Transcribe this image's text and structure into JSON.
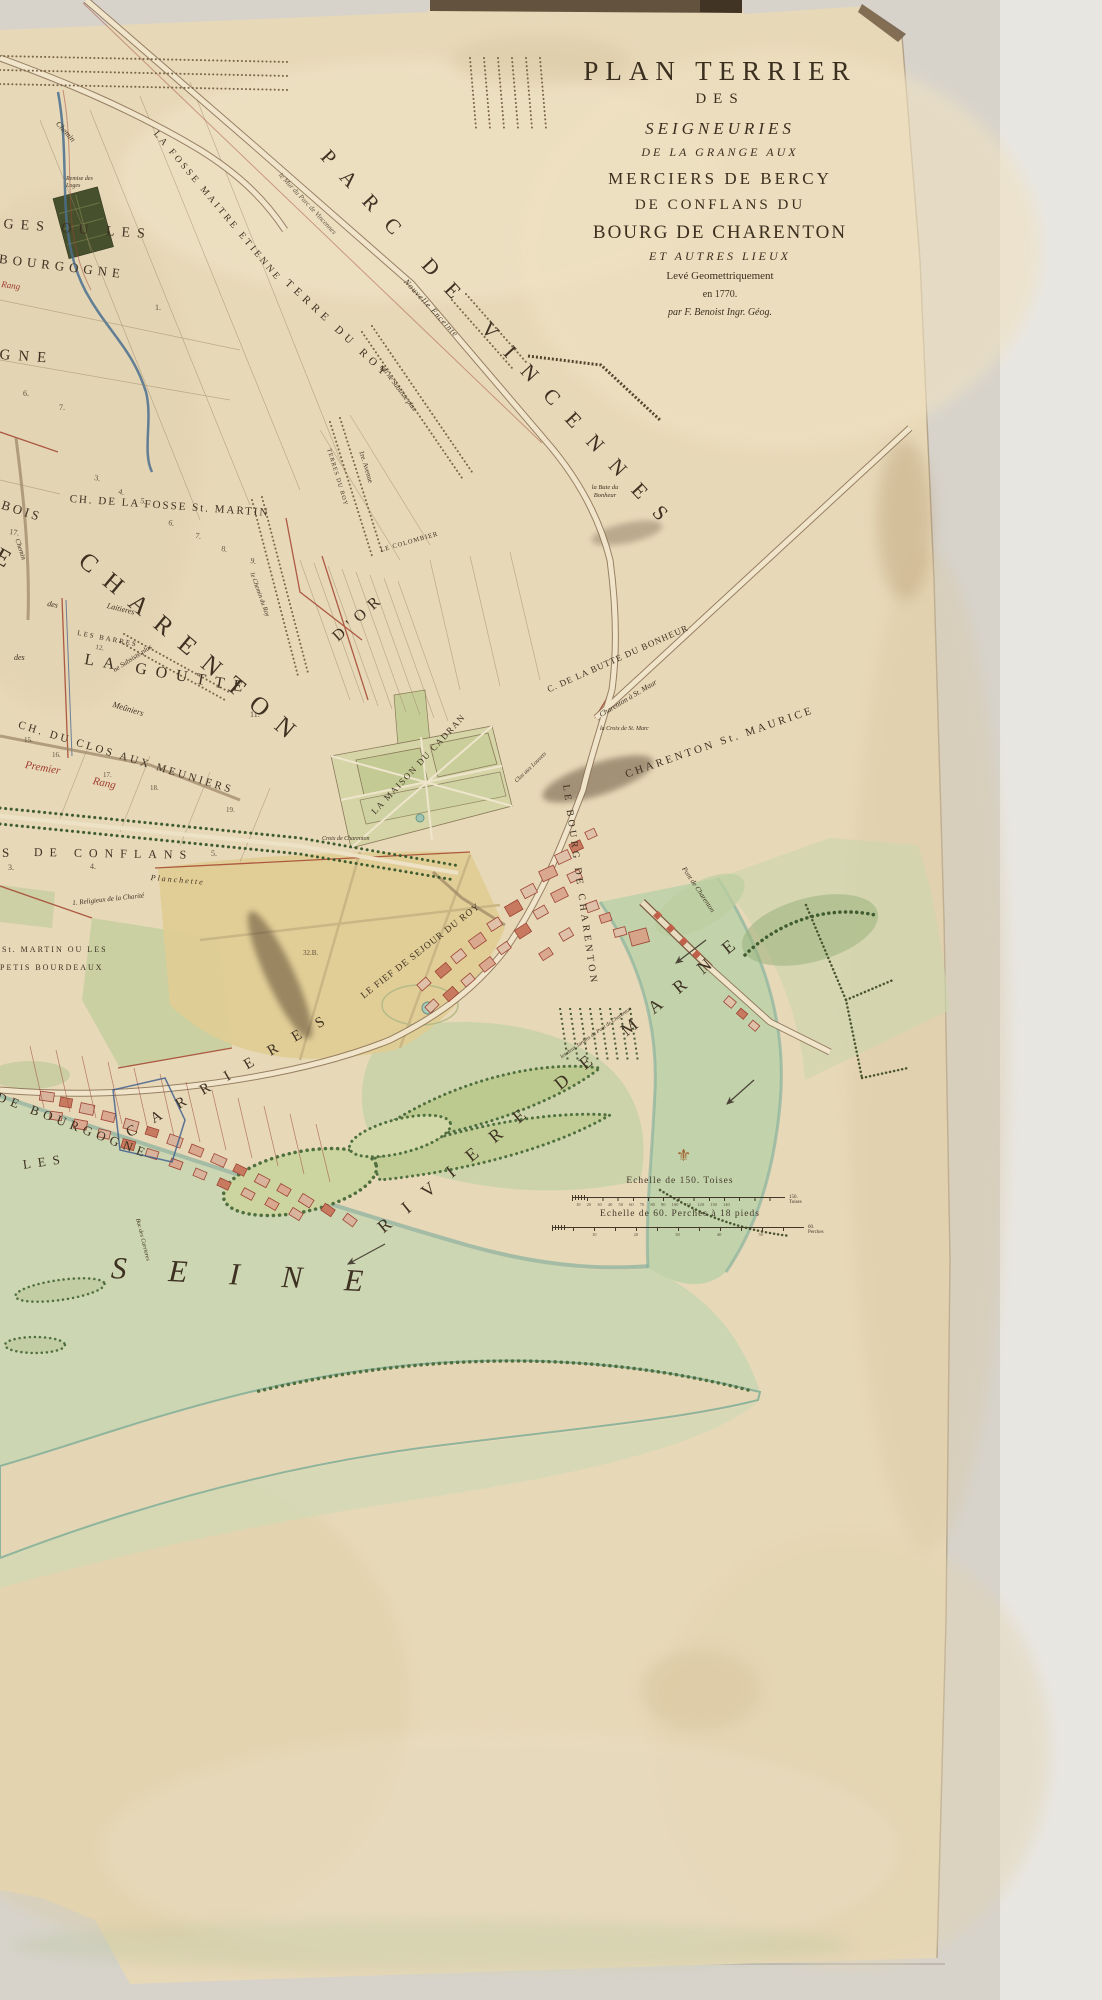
{
  "title": {
    "l1": "PLAN TERRIER",
    "l2": "DES",
    "l3": "SEIGNEURIES",
    "l4": "DE LA GRANGE AUX",
    "l5": "MERCIERS DE BERCY",
    "l6": "DE CONFLANS DU",
    "l7": "BOURG DE CHARENTON",
    "l8": "ET AUTRES LIEUX",
    "l9": "Levé Geomettriquement",
    "l10": "en 1770.",
    "l11": "par F. Benoist Ingr. Géog."
  },
  "labels": {
    "parc_de_vincennes": "PARC DE VINCENNES",
    "mur_parc": "le Mur du Parc de Vincennes",
    "nouvelle_enceinte": "Nouvelle Enceinte",
    "fosse_etienne": "LA FOSSE MAITRE ETIENNE",
    "terre_du_roy": "TERRE DU ROY",
    "terres_du_roy_small": "TERRES DU ROY",
    "chemin": "Chemin",
    "chemin2": "Chemin",
    "remise": "Remise des Loges",
    "ges_ou_les": "GES OU LES",
    "bourgogne": "BOURGOGNE",
    "rang3": "Rang",
    "gne": "GNE",
    "bois": "BOIS",
    "e_letter": "E",
    "ch_fosse_martin": "CH. DE LA FOSSE St. MARTIN",
    "charenton_big": "CHARENTON",
    "la_goutte": "LA GOUTTE",
    "d_or": "D'OR",
    "des1": "des",
    "des2": "des",
    "laitieres": "Laitieres",
    "les_barres": "LES BARRES",
    "ne_subsiste": "ne Subsiste plus",
    "subsiste": "qui ne Subsiste plus",
    "meuniers": "Meûniers",
    "chemin_du_roy": "le Chemin du Roy",
    "avenue": "1re. Avenue",
    "colombier": "LE COLOMBIER",
    "bute_bonheur": "la Bute du Bonheur",
    "ch_clos_meuniers": "CH. DU CLOS AUX MEUNIERS",
    "premier": "Premier",
    "rang": "Rang",
    "s_partial": "S",
    "de_conflans": "DE CONFLANS",
    "planchette": "Planchette",
    "religieux": "1. Religieux de la Charité",
    "st_martin_ou_les": "St. MARTIN OU LES",
    "petis_bourdeaux": "PETIS BOURDEAUX",
    "maison_cadran": "LA MAISON DU CADRAN",
    "croix_charenton": "Croix de Charenton",
    "fief_sejour": "LE FIEF DE SEJOUR DU ROY",
    "bourg_charenton": "LE BOURG DE CHARENTON",
    "butte_bonheur": "C. DE LA BUTTE DU BONHEUR",
    "charenton_st_maur": "Charenton à St. Maur",
    "croix_st_marc": "la Croix de St. Marc",
    "charenton_maurice": "CHARENTON  St. MAURICE",
    "clos_louvets": "Clos aux Louvets",
    "pont_charenton": "Pont de Charenton",
    "jardins_pont": "les deux Jardins du Pont de Charenton",
    "riviere_de_marne": "RIVIERE DE MARNE",
    "de_bourgogne": "DE BOURGOGNE",
    "les": "LES",
    "carrieres": "CARRIERES",
    "bac_carrieres": "Bac des Carrieres",
    "seine": "SEINE"
  },
  "numbers": {
    "f3": "3.",
    "f4": "4.",
    "f5": "5.",
    "f6": "6.",
    "f7": "7.",
    "f8": "8.",
    "f9": "9.",
    "f11": "11.",
    "f12": "12.",
    "f17": "17.",
    "p1": "1.",
    "p6": "6.",
    "p7": "7.",
    "m15": "15.",
    "m16": "16.",
    "m17": "17.",
    "m18": "18.",
    "m19": "19.",
    "c3": "3.",
    "c4": "4.",
    "c5": "5.",
    "b32": "32.B."
  },
  "scale": {
    "toises_title": "Echelle de 150. Toises",
    "toises_ticks": "10 20 30 40 50 60 70 80 90 100 110 120 130 140",
    "toises_end": "150. Toises",
    "perches_title": "Echelle de 60. Perches à 18 pieds",
    "perches_ticks": "10 20 30 40 50",
    "perches_end": "60. Perches"
  },
  "icons": {
    "fleur_de_lis": "⚜"
  },
  "colors": {
    "paper": "#e7d8b8",
    "ink": "#3b2f20",
    "red_ink": "#9e3d2c",
    "water": "#c8d3af",
    "tree_green": "#4f6f3f",
    "backing": "#d7d3cb"
  }
}
